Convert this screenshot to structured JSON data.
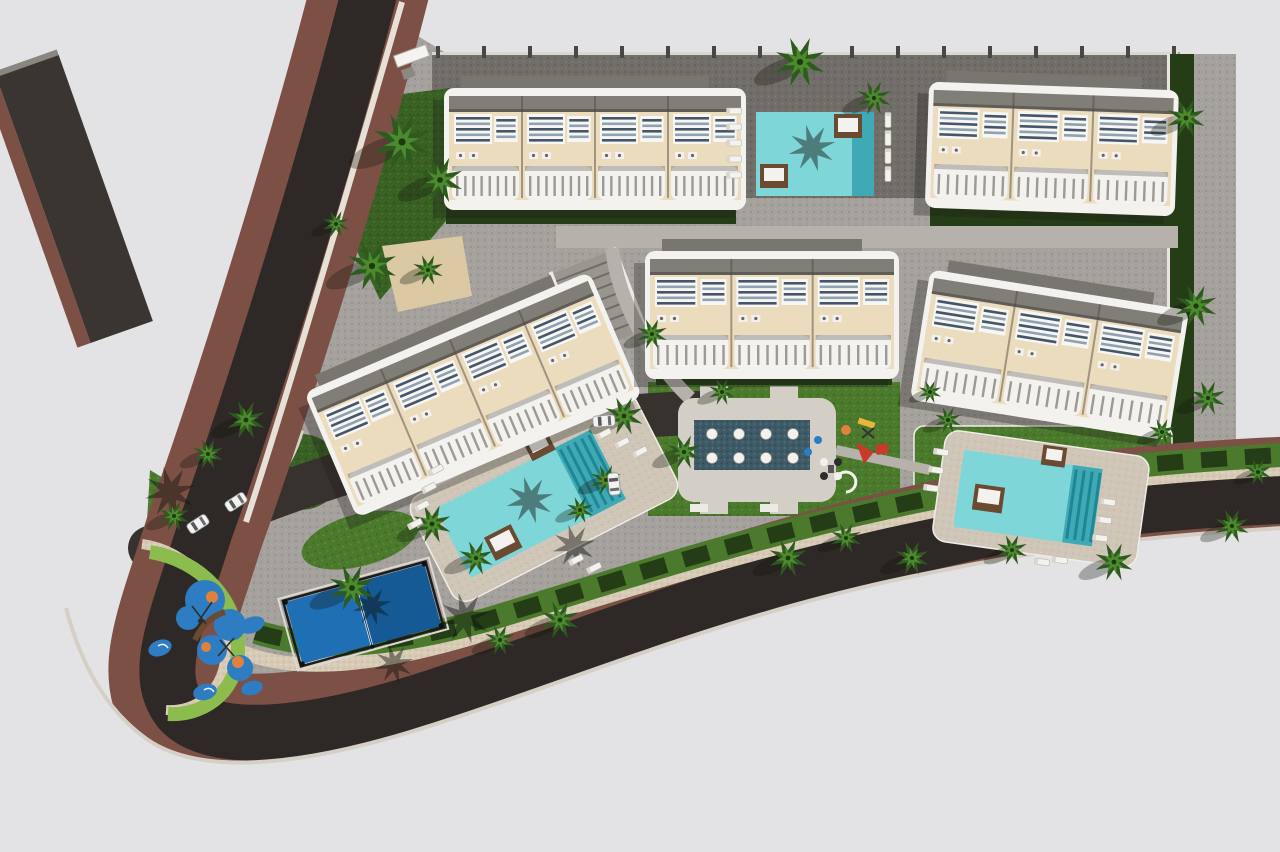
{
  "meta": {
    "title": "Aerial 3D architectural rendering of a residential apartment complex site plan",
    "scene_type": "architectural-render",
    "visible_text": "none"
  },
  "palette": {
    "bg": "#e3e3e5",
    "road": "#2e2926",
    "sidewalk": "#7d5046",
    "curb": "#d8cbb6",
    "paving": "#a5a19c",
    "paving_dark": "#716d68",
    "walkway": "#b6b1ab",
    "facade": "#ecdcbe",
    "white": "#f4f2ee",
    "roof": "#817e78",
    "roof_dark": "#605d58",
    "lawn": "#4b7a2d",
    "lawn_dark": "#3a6124",
    "lawn_light": "#8cbb4e",
    "hedge": "#243d17",
    "palm": "#2d5a1f",
    "palm_light": "#4c8a2d",
    "pool": "#7fd6d8",
    "pool_deep": "#3fa9b5",
    "pool_steps": "#1f8694",
    "deck_beige": "#cfc6b8",
    "wood": "#6b4a32",
    "play_blue": "#2e7dc2",
    "play_orange": "#e0813d",
    "play_red": "#c63b2a",
    "play_yellow": "#e8b63a",
    "court_blue": "#1f6fb5",
    "court_blue_dark": "#155a94",
    "feature_teal": "#3d5a66",
    "shadow": "rgba(25,28,22,0.30)"
  },
  "scene": {
    "areas": [
      {
        "name": "perimeter-road",
        "kind": "asphalt road with maroon sidewalks"
      },
      {
        "name": "townhouse-block-1",
        "kind": "apartment building"
      },
      {
        "name": "townhouse-block-2",
        "kind": "apartment building"
      },
      {
        "name": "townhouse-block-3",
        "kind": "apartment building"
      },
      {
        "name": "townhouse-block-4",
        "kind": "apartment building"
      },
      {
        "name": "townhouse-block-5",
        "kind": "apartment building"
      },
      {
        "name": "top-pool",
        "kind": "swimming pool"
      },
      {
        "name": "central-pool",
        "kind": "swimming pool"
      },
      {
        "name": "right-pool",
        "kind": "swimming pool"
      },
      {
        "name": "padel-court",
        "kind": "sports court"
      },
      {
        "name": "kids-playground",
        "kind": "playground with rubber pads"
      },
      {
        "name": "communal-terrace",
        "kind": "seating terrace with water feature"
      }
    ],
    "buildings": [
      {
        "cx": 595,
        "cy": 146,
        "w": 292,
        "h": 116,
        "rot": 0,
        "units": 4
      },
      {
        "cx": 1052,
        "cy": 146,
        "w": 240,
        "h": 120,
        "rot": 2,
        "units": 3
      },
      {
        "cx": 472,
        "cy": 392,
        "w": 300,
        "h": 130,
        "rot": -23,
        "units": 4
      },
      {
        "cx": 772,
        "cy": 312,
        "w": 244,
        "h": 122,
        "rot": 0,
        "units": 3
      },
      {
        "cx": 1050,
        "cy": 352,
        "w": 252,
        "h": 126,
        "rot": 9,
        "units": 3
      }
    ],
    "palms": [
      [
        402,
        142,
        30
      ],
      [
        440,
        180,
        24
      ],
      [
        372,
        266,
        26
      ],
      [
        336,
        224,
        14
      ],
      [
        428,
        270,
        16
      ],
      [
        800,
        62,
        26
      ],
      [
        874,
        98,
        18
      ],
      [
        1186,
        118,
        20
      ],
      [
        1196,
        306,
        22
      ],
      [
        1208,
        398,
        18
      ],
      [
        1162,
        432,
        14
      ],
      [
        652,
        334,
        16
      ],
      [
        624,
        416,
        20
      ],
      [
        684,
        452,
        18
      ],
      [
        606,
        480,
        16
      ],
      [
        580,
        510,
        14
      ],
      [
        722,
        392,
        14
      ],
      [
        930,
        392,
        12
      ],
      [
        948,
        420,
        14
      ],
      [
        432,
        524,
        20
      ],
      [
        476,
        558,
        18
      ],
      [
        352,
        588,
        24
      ],
      [
        560,
        620,
        20
      ],
      [
        500,
        640,
        16
      ],
      [
        246,
        420,
        20
      ],
      [
        208,
        454,
        16
      ],
      [
        174,
        516,
        16
      ],
      [
        788,
        558,
        20
      ],
      [
        846,
        538,
        16
      ],
      [
        912,
        558,
        18
      ],
      [
        1012,
        550,
        16
      ],
      [
        1114,
        562,
        20
      ],
      [
        1232,
        526,
        18
      ],
      [
        1258,
        472,
        14
      ]
    ],
    "shadow_palms": [
      [
        465,
        618,
        26
      ],
      [
        574,
        546,
        22
      ],
      [
        170,
        492,
        26
      ],
      [
        394,
        664,
        20
      ],
      [
        812,
        148,
        24
      ],
      [
        530,
        500,
        24
      ],
      [
        372,
        606,
        20
      ]
    ],
    "loungers": [
      [
        734,
        111,
        0
      ],
      [
        734,
        127,
        0
      ],
      [
        734,
        143,
        0
      ],
      [
        734,
        159,
        0
      ],
      [
        734,
        175,
        0
      ],
      [
        888,
        120,
        90
      ],
      [
        888,
        138,
        90
      ],
      [
        888,
        156,
        90
      ],
      [
        888,
        174,
        90
      ],
      [
        436,
        470,
        -27
      ],
      [
        429,
        488,
        -27
      ],
      [
        422,
        506,
        -27
      ],
      [
        415,
        524,
        -27
      ],
      [
        604,
        434,
        -27
      ],
      [
        622,
        443,
        -27
      ],
      [
        640,
        452,
        -27
      ],
      [
        576,
        560,
        -27
      ],
      [
        594,
        568,
        -27
      ],
      [
        941,
        452,
        8
      ],
      [
        936,
        470,
        8
      ],
      [
        931,
        488,
        8
      ],
      [
        1108,
        502,
        8
      ],
      [
        1104,
        520,
        8
      ],
      [
        1100,
        538,
        8
      ],
      [
        1042,
        562,
        8
      ],
      [
        1060,
        560,
        8
      ]
    ],
    "cars": [
      [
        198,
        524,
        -33
      ],
      [
        236,
        502,
        -33
      ],
      [
        604,
        421,
        -4
      ],
      [
        614,
        484,
        84
      ]
    ],
    "fence": {
      "x0": 436,
      "x1": 1176,
      "y": 46,
      "step": 46,
      "w": 4,
      "h": 12
    }
  }
}
